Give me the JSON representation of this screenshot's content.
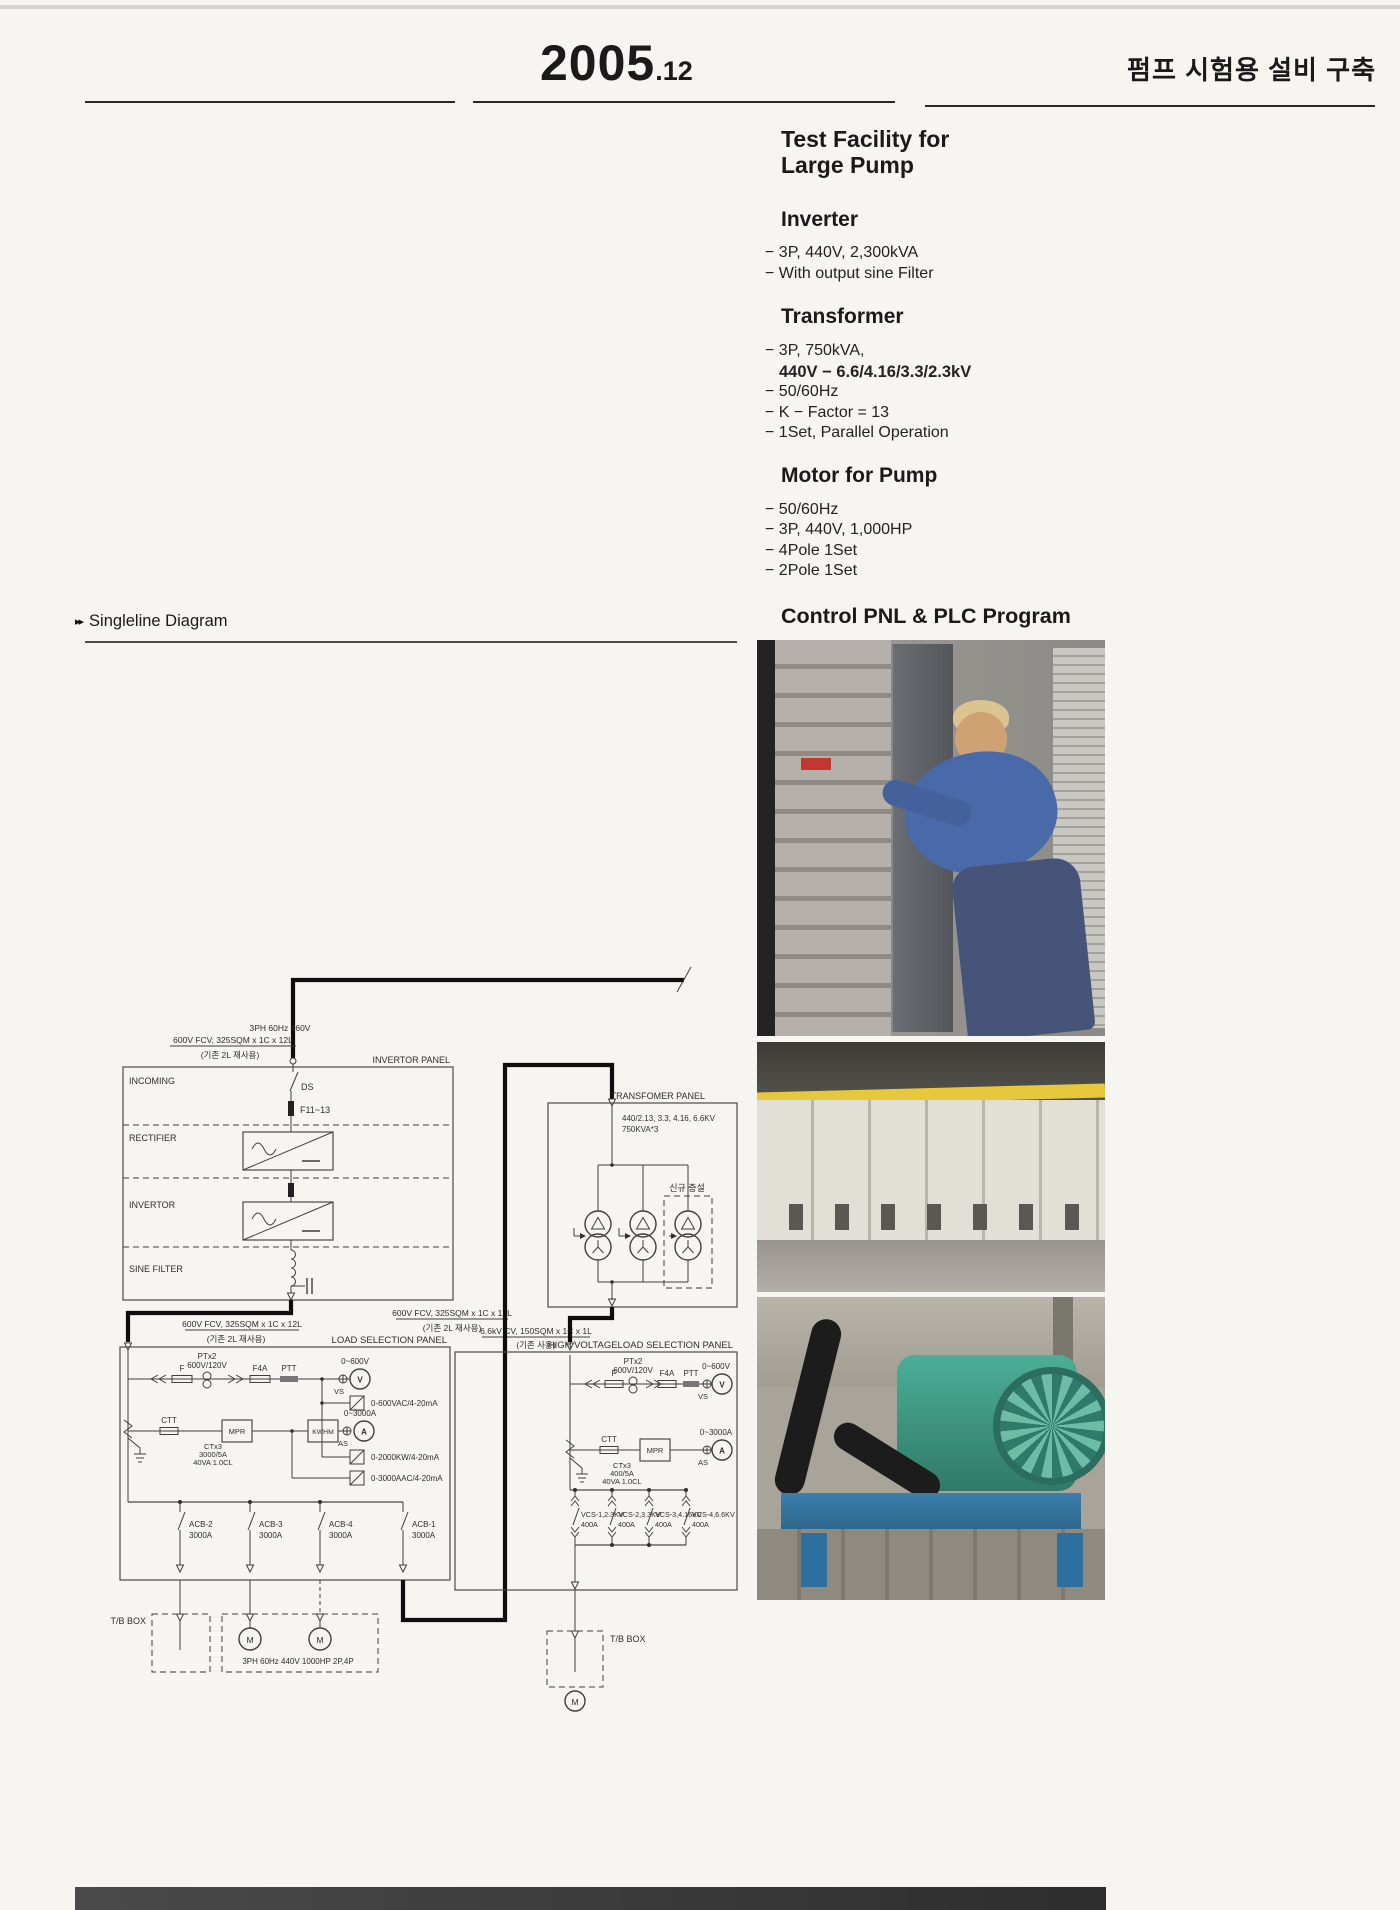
{
  "header": {
    "year": "2005",
    "month": ".12",
    "korean_title": "펌프 시험용 설비 구축"
  },
  "specs": {
    "title_line1": "Test Facility for",
    "title_line2": "Large Pump",
    "sections": [
      {
        "heading": "Inverter",
        "items": [
          "− 3P, 440V, 2,300kVA",
          "− With output sine Filter"
        ]
      },
      {
        "heading": "Transformer",
        "items": [
          "− 3P, 750kVA,",
          "440V − 6.6/4.16/3.3/2.3kV",
          "− 50/60Hz",
          "− K − Factor = 13",
          "− 1Set, Parallel Operation"
        ]
      },
      {
        "heading": "Motor for Pump",
        "items": [
          "− 50/60Hz",
          "− 3P, 440V, 1,000HP",
          "− 4Pole 1Set",
          "− 2Pole 1Set"
        ]
      }
    ],
    "control_heading": "Control PNL & PLC Program"
  },
  "diagram": {
    "heading_marker": "▸▸",
    "heading": "Singleline Diagram",
    "feed": {
      "phase": "3PH 60Hz 460V",
      "cable": "600V FCV, 325SQM x 1C x 12L",
      "reuse": "(기존 2L 재사용)"
    },
    "invertor_panel": {
      "title": "INVERTOR PANEL",
      "incoming": "INCOMING",
      "rectifier": "RECTIFIER",
      "invertor": "INVERTOR",
      "sine_filter": "SINE FILTER",
      "ds": "DS",
      "fuse": "F11~13"
    },
    "link1": {
      "cable": "600V FCV, 325SQM x 1C x 12L",
      "reuse": "(기존 2L 재사용)"
    },
    "link2": {
      "cable": "600V FCV, 325SQM x 1C x 12L",
      "reuse": "(기존 2L 재사용)"
    },
    "link3": {
      "cable": "6.6kV CV, 150SQM x 1C x 1L",
      "reuse": "(기존 사용)"
    },
    "transformer_panel": {
      "title": "TRANSFOMER PANEL",
      "rating1": "440/2.13, 3.3, 4.16, 6.6KV",
      "rating2": "750KVA*3",
      "new_install": "신규 증설"
    },
    "load_panel": {
      "title": "LOAD SELECTION PANEL",
      "pt": "PTx2",
      "pt_ratio": "600V/120V",
      "f": "F",
      "f4a": "F4A",
      "ptt": "PTT",
      "v_range": "0~600V",
      "v": "V",
      "vs": "VS",
      "ctt": "CTT",
      "mpr": "MPR",
      "ct": "CTx3",
      "ct_ratio": "3000/5A",
      "ct_class": "40VA 1.0CL",
      "kwhm": "KWHM",
      "a_range": "0~3000A",
      "a": "A",
      "as": "AS",
      "tx1": "0-600VAC/4-20mA",
      "tx2": "0-2000KW/4-20mA",
      "tx3": "0-3000AAC/4-20mA",
      "breakers": [
        {
          "name": "ACB-2",
          "amp": "3000A"
        },
        {
          "name": "ACB-3",
          "amp": "3000A"
        },
        {
          "name": "ACB-4",
          "amp": "3000A"
        },
        {
          "name": "ACB-1",
          "amp": "3000A"
        }
      ]
    },
    "hv_panel": {
      "title": "HIGH VOLTAGELOAD SELECTION PANEL",
      "pt": "PTx2",
      "pt_ratio": "600V/120V",
      "f": "F",
      "f4a": "F4A",
      "ptt": "PTT",
      "v_range": "0~600V",
      "v": "V",
      "vs": "VS",
      "ctt": "CTT",
      "mpr": "MPR",
      "ct": "CTx3",
      "ct_ratio": "400/5A",
      "ct_class": "40VA 1.0CL",
      "a_range": "0~3000A",
      "a": "A",
      "as": "AS",
      "breakers": [
        {
          "name": "VCS-1,2.3KV",
          "amp": "400A"
        },
        {
          "name": "VCS-2,3.3KV",
          "amp": "400A"
        },
        {
          "name": "VCS-3,4.16KV",
          "amp": "400A"
        },
        {
          "name": "VCS-4,6.6KV",
          "amp": "400A"
        }
      ]
    },
    "tb_left": {
      "label": "T/B BOX",
      "motor": "M",
      "motor_spec": "3PH 60Hz 440V 1000HP 2P,4P"
    },
    "tb_right": {
      "label": "T/B BOX",
      "motor": "M"
    }
  },
  "colors": {
    "rule": "#2b2b2b",
    "thick_line": "#0e0e0e",
    "photo2_accent": "#e6c83c",
    "photo3_machine": "#3f9f8a"
  }
}
